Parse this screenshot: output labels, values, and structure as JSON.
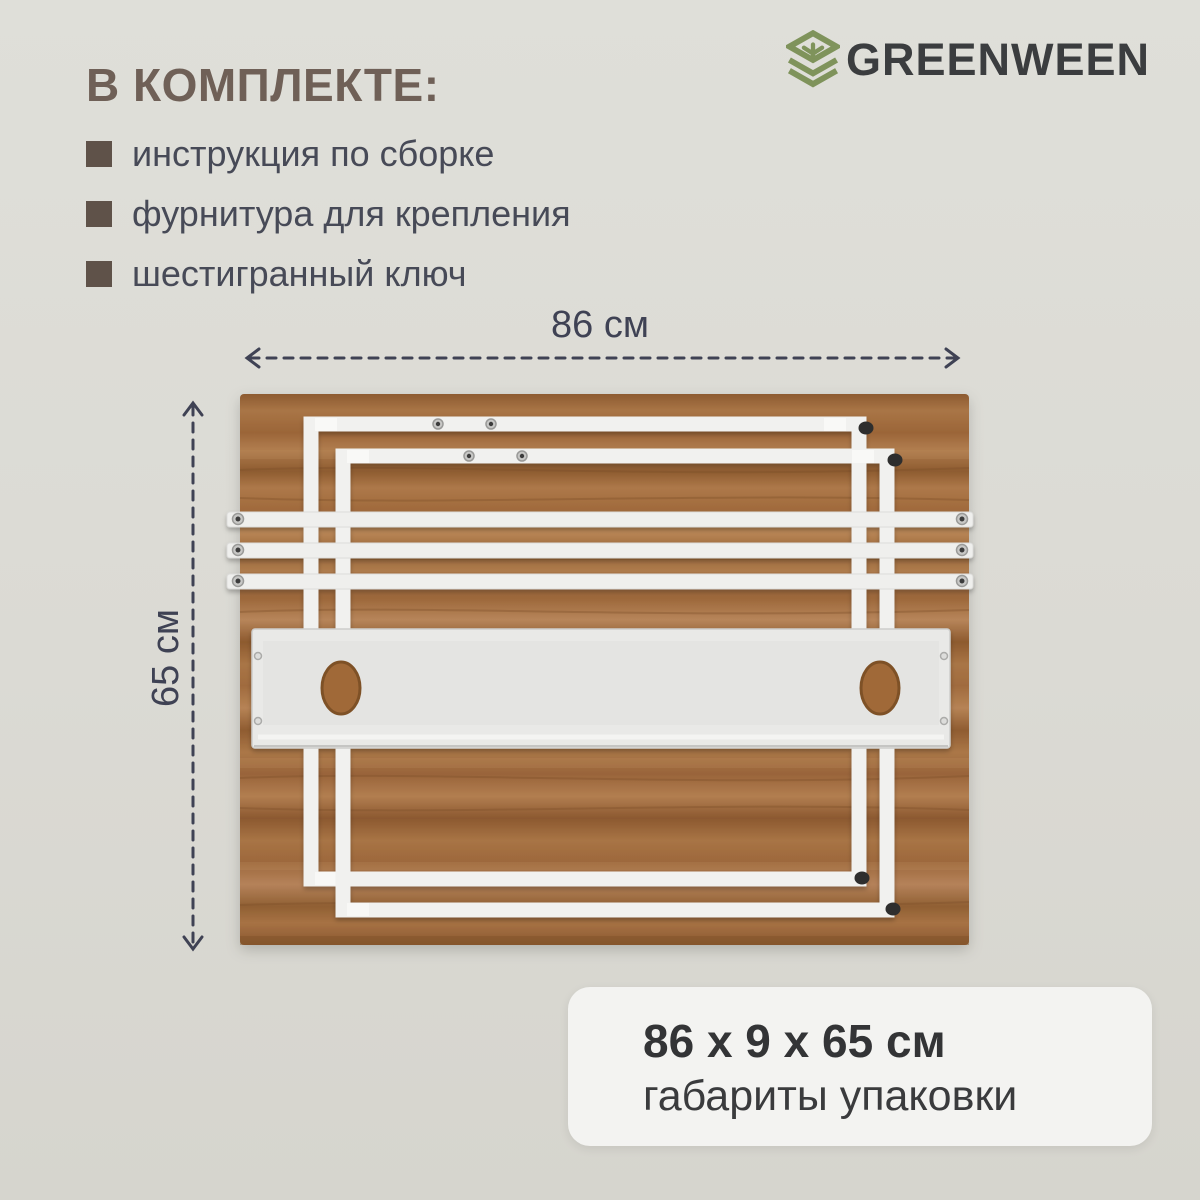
{
  "page": {
    "background_top": "#DFDFD9",
    "background_bottom": "#D6D5CE"
  },
  "logo": {
    "brand": "GREENWEEN",
    "icon": "box-sprout-icon",
    "icon_color": "#7F935B",
    "text_color": "#3B3D3F"
  },
  "kit": {
    "heading": "В КОМПЛЕКТЕ:",
    "heading_color": "#6F6057",
    "bullet_color": "#5F5249",
    "items": [
      {
        "label": "инструкция по сборке"
      },
      {
        "label": "фурнитура для крепления"
      },
      {
        "label": "шестигранный ключ"
      }
    ]
  },
  "diagram": {
    "width_label": "86 см",
    "height_label": "65 см",
    "annotation_color": "#3F4254",
    "wood_color": "#A97546",
    "metal_color": "#F0F0EE"
  },
  "package_card": {
    "dimensions": "86 x 9 x 65 см",
    "caption": "габариты упаковки"
  }
}
